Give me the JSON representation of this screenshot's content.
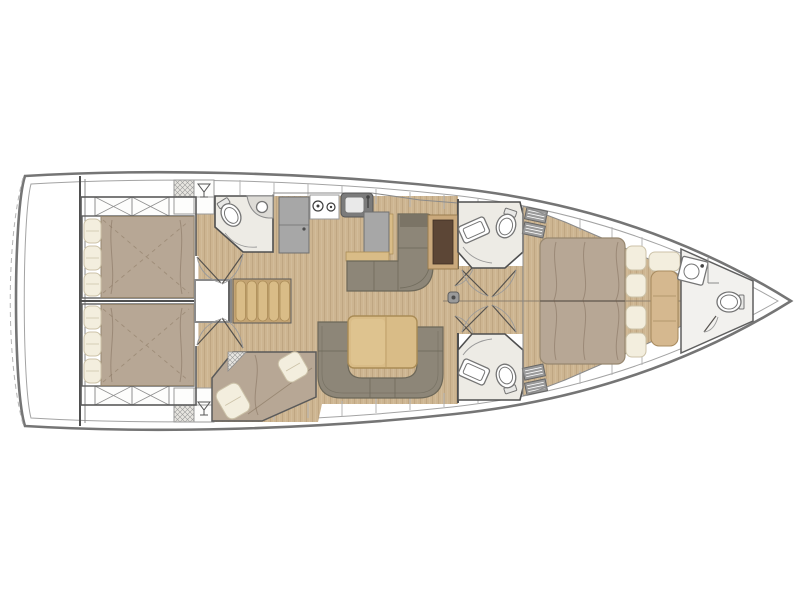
{
  "canvas": {
    "width": 800,
    "height": 600,
    "background": "#ffffff"
  },
  "diagram": {
    "kind": "sailing-yacht-interior-deck-plan",
    "orientation": "bow-right",
    "areas": [
      {
        "id": "swim-platform"
      },
      {
        "id": "aft-cabin-port"
      },
      {
        "id": "aft-cabin-starboard"
      },
      {
        "id": "aft-head"
      },
      {
        "id": "galley"
      },
      {
        "id": "companionway-steps"
      },
      {
        "id": "engine-hatch"
      },
      {
        "id": "salon-settee"
      },
      {
        "id": "salon-dinette"
      },
      {
        "id": "bunk-cabin"
      },
      {
        "id": "forward-head-port"
      },
      {
        "id": "forward-head-starboard"
      },
      {
        "id": "owners-cabin"
      },
      {
        "id": "bow-head"
      },
      {
        "id": "forepeak"
      }
    ],
    "icons": [
      "martini-glass-icon",
      "toilet-icon",
      "sink-icon",
      "stove-burner-icon",
      "shower-curve-icon",
      "hatch-cross-icon",
      "vent-grill-icon",
      "stairs-icon",
      "mast-post-icon",
      "door-swing-icon"
    ]
  },
  "colors": {
    "hull": "#757575",
    "hullInner": "#a3a3a3",
    "wall": "#4f4f4f",
    "wallLight": "#8a8a8a",
    "wood": "#cdb591",
    "woodLine": "#b59c78",
    "bed": "#b7a795",
    "bedLine": "#97876f",
    "pillow": "#f3eede",
    "pillowLine": "#ccc2a8",
    "sofa": "#8d8678",
    "sofaDark": "#6d6859",
    "sofaBack": "#7b7466",
    "tableWood": "#d9bc87",
    "tableWoodDark": "#aa8c56",
    "counter": "#a7a7a7",
    "counterDark": "#6f6f6f",
    "appliance": "#7b7b7b",
    "bathFloor": "#edebe5",
    "fixture": "#757575",
    "wardrobe": "#5c4636",
    "vent": "#9a9a9a",
    "divider": "#b5b5b5",
    "white": "#ffffff"
  }
}
